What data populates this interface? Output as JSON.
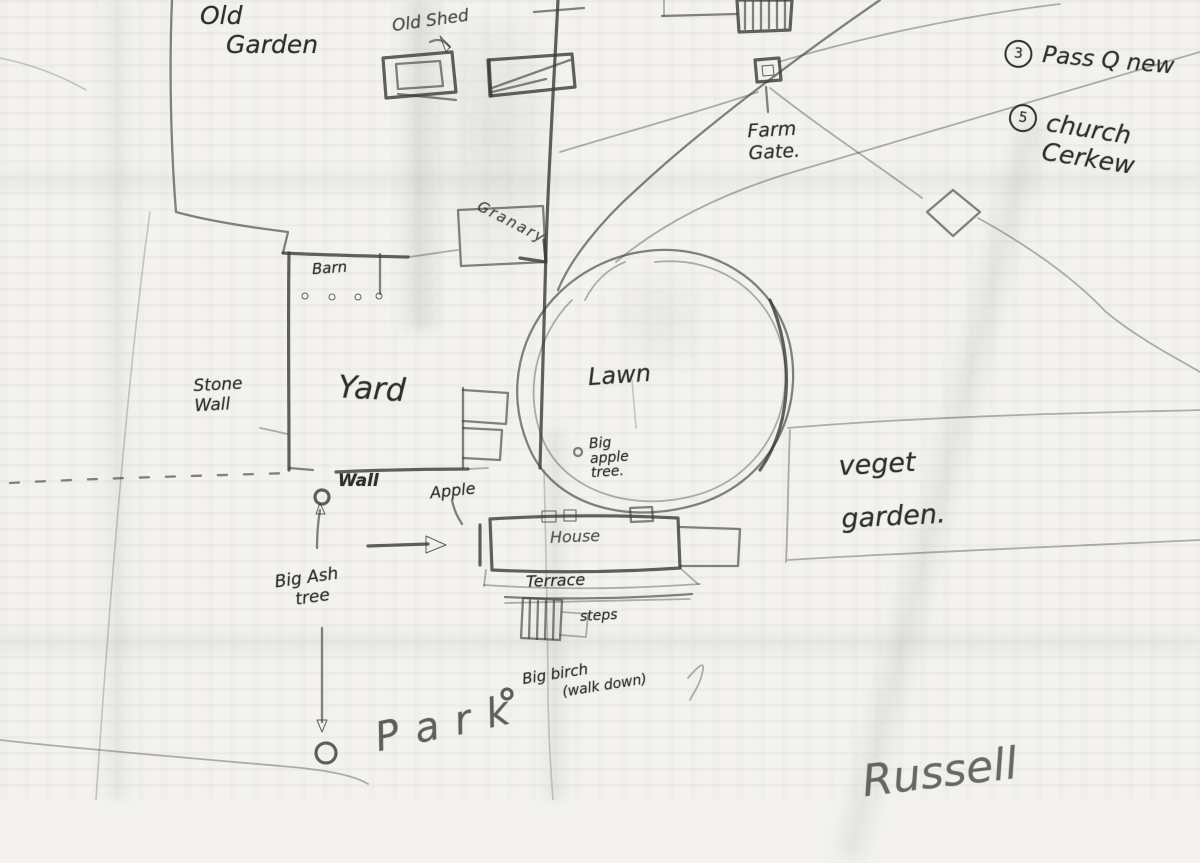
{
  "colors": {
    "pencil": "#3a3a3a",
    "paper": "#f3f2ef"
  },
  "map": {
    "labels": {
      "old_garden_line1": "Old",
      "old_garden_line2": "Garden",
      "old_shed": "Old Shed",
      "farm_gate": "Farm\nGate.",
      "note_pass_badge": "3",
      "note_pass_text": "Pass Q new",
      "note_church_badge": "5",
      "note_church_text": "church\nCerkew",
      "granary": "Granary",
      "barn": "Barn",
      "yard": "Yard",
      "stone_wall": "Stone\nWall",
      "lawn": "Lawn",
      "big_apple_tree": "Big\napple\ntree.",
      "wall": "Wall",
      "apple": "Apple",
      "house": "House",
      "terrace": "Terrace",
      "steps": "steps",
      "veget_garden": "veget\ngarden.",
      "big_ash_line1": "Big Ash",
      "big_ash_line2": "tree",
      "park": "Park",
      "big_birch": "Big birch",
      "big_birch_note": "(walk down)",
      "russell": "Russell"
    },
    "features": [
      "old-shed-building",
      "long-outbuilding",
      "hatched-building",
      "farm-gate-square",
      "granary-box",
      "barn-box",
      "yard-walls",
      "stone-wall-line",
      "dashed-boundary",
      "lawn-loop",
      "house-block",
      "terrace-steps",
      "veget-garden-boundary",
      "tilted-building",
      "well-circle",
      "ash-tree-circle",
      "park-tree-circle",
      "birch-tree-circle",
      "direction-arrow-right",
      "arrow-to-ash",
      "arrow-to-park",
      "farm-track",
      "field-boundary",
      "park-boundary"
    ]
  }
}
